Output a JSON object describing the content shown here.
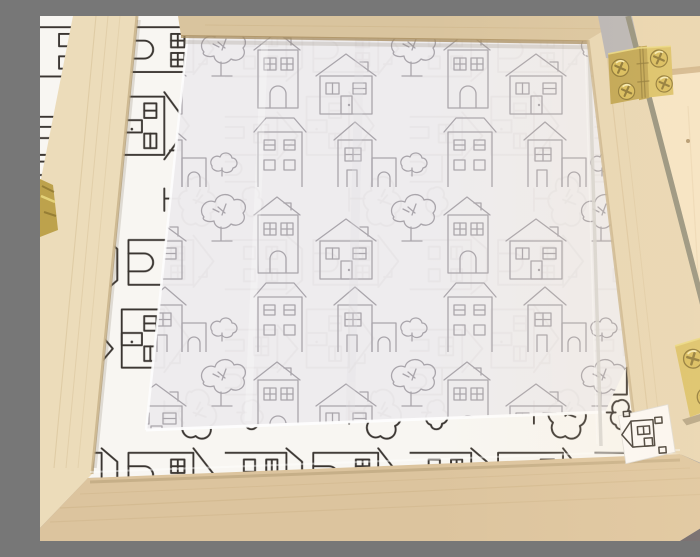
{
  "scene": {
    "description": "Close-up photograph of an open pale-wood hinged box. The inside is lined with white paper printed with hand-drawn doodle houses and trees; a translucent tissue sheet covers the centre so the pattern shows through faintly grey. Small brass butt hinges with gold cross-head screws join the frame to the open lid on the right, and part of another hinge shows at the left edge.",
    "objects": {
      "frame": "pale wooden box frame",
      "paper": "white lining paper printed with doodle houses",
      "tissue": "translucent tissue overlay with faded house pattern",
      "hinge_top": "brass butt hinge, four gold screws",
      "hinge_right": "brass butt hinge, four gold screws",
      "hinge_left": "partially visible brass hinge at left edge",
      "lid": "open wooden lid panel",
      "paper_scrap": "small paper offcut with a house doodle",
      "background": "grey surface behind the box"
    },
    "pattern_motifs": [
      "tall house",
      "gable house",
      "fluffy tree",
      "two-storey house",
      "house with annex",
      "bush"
    ]
  },
  "colors": {
    "bg_grey": "#9b9aa0",
    "bg_grey_light": "#b5b3b6",
    "bg_grey_dark": "#5e5963",
    "paper_white": "#f8f6f2",
    "ink_crisp": "#3a3531",
    "tissue_white": "#edebed",
    "ink_faded": "#a9a5ab",
    "tissue_highlight": "#fdfdfd",
    "wood_left": "#ecdcba",
    "wood_top": "#d9c49e",
    "wood_right": "#e7d6b4",
    "wood_bottom": "#dcc49e",
    "wood_edge": "#a58b5c",
    "wood_grain": "#c4a878",
    "lid_warm": "#f5e5c7",
    "lid_bar": "#e8d5b0",
    "lid_shadow": "#c9ad82",
    "gap_olive": "#8e8c7a",
    "brass": "#bda24c",
    "brass_light": "#d9c063",
    "brass_bright": "#e9d87e",
    "brass_dark": "#86702c",
    "screw_gold": "#d6ba55",
    "glass_edge": "#d5d3d0",
    "warm_glow": "#ffe4b8"
  }
}
